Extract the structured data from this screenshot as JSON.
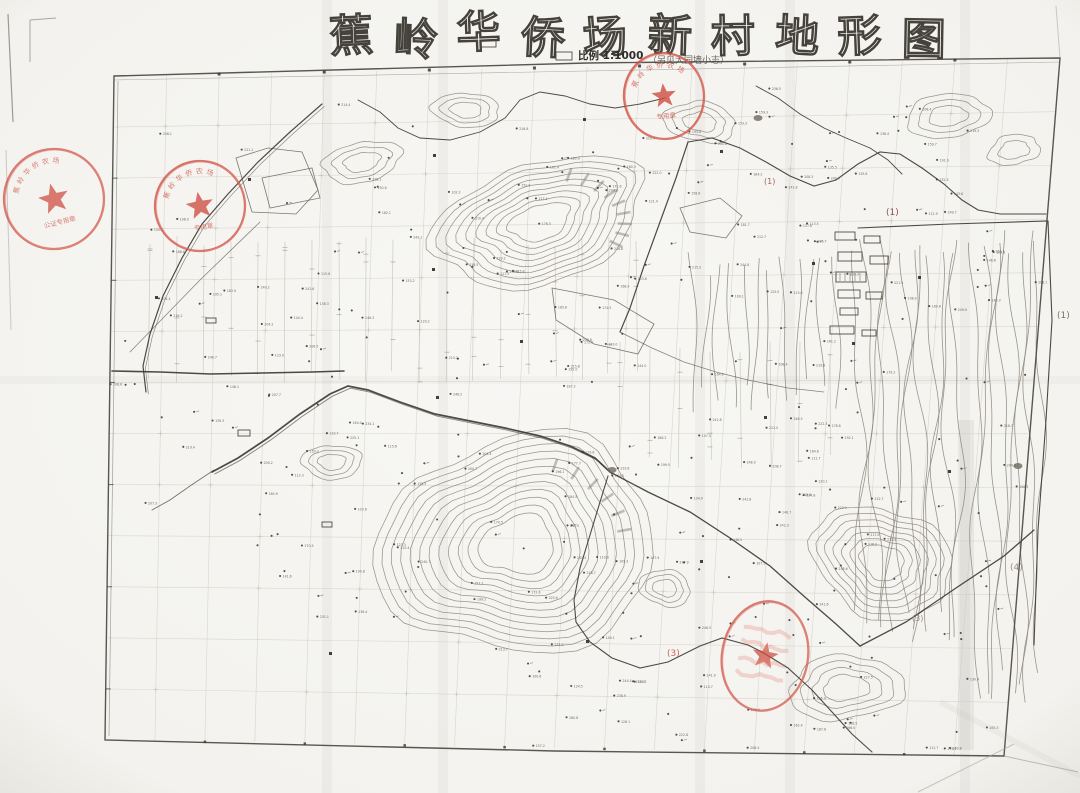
{
  "page": {
    "background": "#f6f5f1",
    "paper_shadow": "#e7e5e0"
  },
  "colors": {
    "ink": "#3e3b35",
    "contour": "#8a857a",
    "contour_dark": "#6e695f",
    "pencil": "#cfccc3",
    "stamp_red": "#cd4a3d",
    "stamp_red_light": "#e2786c",
    "paper": "#f8f7f4"
  },
  "title": {
    "text": "蕉岭华侨场新村地形图",
    "chars": [
      "蕉",
      "岭",
      "华",
      "侨",
      "场",
      "新",
      "村",
      "地",
      "形",
      "图"
    ],
    "x_start": 330,
    "spacing": 63.5,
    "font_size": 44
  },
  "scale": {
    "label": "比例 1:1000",
    "note": "（另见大园墙小志）"
  },
  "stamps": [
    {
      "name": "seal-top-center",
      "cx": 664,
      "cy": 96,
      "rx": 40,
      "ry": 43,
      "rot": -6,
      "ring_text": "蕉岭华侨农场",
      "bottom_text": "专用章",
      "style": "circle",
      "opacity": 0.88
    },
    {
      "name": "seal-left-edge",
      "cx": 54,
      "cy": 199,
      "rx": 50,
      "ry": 50,
      "rot": -14,
      "ring_text": "蕉岭华侨农场",
      "bottom_text": "公证专用章",
      "style": "circle",
      "opacity": 0.8
    },
    {
      "name": "seal-upper-left",
      "cx": 200,
      "cy": 206,
      "rx": 45,
      "ry": 45,
      "rot": -10,
      "ring_text": "蕉岭华侨农场",
      "bottom_text": "专用章",
      "style": "circle",
      "opacity": 0.85
    },
    {
      "name": "seal-bottom",
      "cx": 765,
      "cy": 656,
      "rx": 43,
      "ry": 55,
      "rot": 10,
      "ring_text": "",
      "bottom_text": "",
      "style": "scribble",
      "opacity": 0.8
    }
  ],
  "annotations": [
    {
      "text": "(1)",
      "x": 886,
      "y": 215,
      "color": "#7c453e",
      "size": 9
    },
    {
      "text": "(1)",
      "x": 1057,
      "y": 318,
      "color": "#6b675f",
      "size": 9
    },
    {
      "text": "(1)",
      "x": 764,
      "y": 184,
      "color": "#95544b",
      "size": 8
    },
    {
      "text": "(4)",
      "x": 1010,
      "y": 570,
      "color": "#8b867d",
      "size": 9
    },
    {
      "text": "(3)",
      "x": 667,
      "y": 656,
      "color": "#c4574a",
      "size": 9
    },
    {
      "text": "(3)",
      "x": 912,
      "y": 621,
      "color": "#8b867d",
      "size": 8
    }
  ],
  "map": {
    "border": {
      "corners": [
        [
          114,
          76
        ],
        [
          1060,
          58
        ],
        [
          1004,
          756
        ],
        [
          105,
          740
        ]
      ],
      "grid_cols": 18,
      "grid_rows": 13
    },
    "hills": [
      {
        "cx": 540,
        "cy": 222,
        "rx": 108,
        "ry": 60,
        "rings": 9,
        "rot": -18,
        "seed": 11,
        "hatch": 9
      },
      {
        "cx": 362,
        "cy": 162,
        "rx": 40,
        "ry": 20,
        "rings": 3,
        "rot": -12,
        "seed": 21,
        "hatch": 0
      },
      {
        "cx": 466,
        "cy": 110,
        "rx": 34,
        "ry": 17,
        "rings": 3,
        "rot": 4,
        "seed": 31,
        "hatch": 0
      },
      {
        "cx": 700,
        "cy": 122,
        "rx": 36,
        "ry": 20,
        "rings": 3,
        "rot": 8,
        "seed": 41,
        "hatch": 0
      },
      {
        "cx": 948,
        "cy": 116,
        "rx": 42,
        "ry": 22,
        "rings": 3,
        "rot": -6,
        "seed": 51,
        "hatch": 0
      },
      {
        "cx": 332,
        "cy": 462,
        "rx": 30,
        "ry": 17,
        "rings": 3,
        "rot": 0,
        "seed": 61,
        "hatch": 0
      },
      {
        "cx": 518,
        "cy": 545,
        "rx": 140,
        "ry": 108,
        "rings": 12,
        "rot": -8,
        "seed": 71,
        "hatch": 6
      },
      {
        "cx": 665,
        "cy": 588,
        "rx": 26,
        "ry": 18,
        "rings": 3,
        "rot": 12,
        "seed": 81,
        "hatch": 0
      },
      {
        "cx": 882,
        "cy": 562,
        "rx": 72,
        "ry": 54,
        "rings": 7,
        "rot": 22,
        "seed": 91,
        "hatch": 0
      },
      {
        "cx": 846,
        "cy": 688,
        "rx": 58,
        "ry": 32,
        "rings": 4,
        "rot": -4,
        "seed": 101,
        "hatch": 0
      },
      {
        "cx": 1014,
        "cy": 150,
        "rx": 26,
        "ry": 15,
        "rings": 2,
        "rot": -10,
        "seed": 111,
        "hatch": 0
      }
    ],
    "slopes": [
      {
        "x": 858,
        "y0": 234,
        "y1": 646,
        "n": 12,
        "dx": 9,
        "amp": 6,
        "seed": 5
      },
      {
        "x": 976,
        "y0": 230,
        "y1": 706,
        "n": 8,
        "dx": 9,
        "amp": 5,
        "seed": 6
      },
      {
        "x": 692,
        "y0": 252,
        "y1": 418,
        "n": 12,
        "dx": 13,
        "amp": 4,
        "seed": 7
      }
    ],
    "lines": [
      {
        "pts": [
          [
            212,
            472
          ],
          [
            238,
            458
          ],
          [
            268,
            438
          ],
          [
            300,
            414
          ],
          [
            330,
            394
          ],
          [
            348,
            386
          ],
          [
            368,
            390
          ],
          [
            400,
            402
          ],
          [
            435,
            414
          ],
          [
            470,
            421
          ],
          [
            505,
            428
          ],
          [
            540,
            436
          ],
          [
            570,
            446
          ],
          [
            595,
            458
          ],
          [
            610,
            472
          ]
        ],
        "w": 1.7,
        "double": true
      },
      {
        "pts": [
          [
            610,
            472
          ],
          [
            648,
            492
          ],
          [
            690,
            512
          ],
          [
            730,
            538
          ],
          [
            770,
            566
          ],
          [
            806,
            598
          ],
          [
            836,
            624
          ],
          [
            860,
            646
          ]
        ],
        "w": 1.3
      },
      {
        "pts": [
          [
            860,
            646
          ],
          [
            906,
            622
          ],
          [
            956,
            588
          ],
          [
            1004,
            556
          ],
          [
            1034,
            530
          ]
        ],
        "w": 1.3
      },
      {
        "pts": [
          [
            608,
            476
          ],
          [
            600,
            502
          ],
          [
            590,
            535
          ],
          [
            580,
            568
          ],
          [
            574,
            600
          ],
          [
            576,
            622
          ],
          [
            590,
            642
          ],
          [
            612,
            658
          ],
          [
            640,
            668
          ],
          [
            668,
            662
          ],
          [
            700,
            646
          ],
          [
            722,
            638
          ],
          [
            748,
            645
          ],
          [
            762,
            652
          ]
        ],
        "w": 1.1
      },
      {
        "pts": [
          [
            762,
            652
          ],
          [
            788,
            668
          ],
          [
            812,
            690
          ],
          [
            832,
            712
          ],
          [
            852,
            734
          ],
          [
            872,
            752
          ]
        ],
        "w": 1.1
      },
      {
        "pts": [
          [
            688,
            142
          ],
          [
            676,
            178
          ],
          [
            660,
            222
          ],
          [
            644,
            266
          ],
          [
            630,
            308
          ],
          [
            620,
            332
          ]
        ],
        "w": 1.2
      },
      {
        "pts": [
          [
            688,
            142
          ],
          [
            712,
            138
          ],
          [
            740,
            148
          ],
          [
            766,
            162
          ],
          [
            790,
            176
          ],
          [
            814,
            186
          ],
          [
            836,
            180
          ],
          [
            858,
            164
          ],
          [
            880,
            152
          ],
          [
            900,
            154
          ],
          [
            922,
            168
          ],
          [
            944,
            184
          ],
          [
            962,
            200
          ],
          [
            978,
            210
          ],
          [
            1000,
            214
          ],
          [
            1024,
            214
          ],
          [
            1046,
            214
          ]
        ],
        "w": 1.1
      },
      {
        "pts": [
          [
            322,
            104
          ],
          [
            290,
            132
          ],
          [
            258,
            162
          ],
          [
            228,
            194
          ],
          [
            202,
            224
          ],
          [
            182,
            258
          ],
          [
            163,
            296
          ],
          [
            150,
            334
          ],
          [
            143,
            366
          ],
          [
            146,
            392
          ]
        ],
        "w": 1.2,
        "double": true
      },
      {
        "pts": [
          [
            112,
            371
          ],
          [
            160,
            372
          ],
          [
            210,
            374
          ],
          [
            262,
            373
          ],
          [
            312,
            372
          ],
          [
            344,
            371
          ]
        ],
        "w": 1.6
      },
      {
        "pts": [
          [
            358,
            100
          ],
          [
            380,
            112
          ],
          [
            398,
            128
          ],
          [
            420,
            138
          ],
          [
            450,
            140
          ],
          [
            480,
            132
          ],
          [
            505,
            118
          ],
          [
            520,
            100
          ],
          [
            540,
            92
          ],
          [
            565,
            96
          ],
          [
            590,
            104
          ],
          [
            615,
            108
          ],
          [
            640,
            104
          ],
          [
            665,
            98
          ]
        ],
        "w": 0.9
      },
      {
        "pts": [
          [
            756,
            86
          ],
          [
            778,
            98
          ],
          [
            800,
            114
          ],
          [
            824,
            128
          ],
          [
            846,
            138
          ],
          [
            870,
            148
          ],
          [
            888,
            160
          ],
          [
            902,
            174
          ]
        ],
        "w": 0.9
      },
      {
        "pts": [
          [
            858,
            228
          ],
          [
            950,
            224
          ],
          [
            1048,
            221
          ],
          [
            1052,
            320
          ],
          [
            1046,
            420
          ],
          [
            1038,
            530
          ],
          [
            1034,
            645
          ]
        ],
        "w": 1.1
      },
      {
        "pts": [
          [
            130,
            352
          ],
          [
            200,
            280
          ],
          [
            260,
            222
          ]
        ],
        "w": 0.8,
        "op": 0.6
      },
      {
        "pts": [
          [
            620,
            332
          ],
          [
            652,
            348
          ],
          [
            684,
            362
          ],
          [
            716,
            372
          ],
          [
            748,
            380
          ],
          [
            788,
            388
          ],
          [
            824,
            392
          ]
        ],
        "w": 0.8,
        "op": 0.6
      },
      {
        "pts": [
          [
            214,
            470
          ],
          [
            190,
            486
          ],
          [
            170,
            500
          ],
          [
            152,
            510
          ]
        ],
        "w": 0.9,
        "op": 0.7
      }
    ],
    "polygons": [
      [
        [
          236,
          158
        ],
        [
          268,
          148
        ],
        [
          302,
          152
        ],
        [
          318,
          190
        ],
        [
          296,
          214
        ],
        [
          252,
          212
        ]
      ],
      [
        [
          552,
          288
        ],
        [
          614,
          300
        ],
        [
          654,
          324
        ],
        [
          638,
          354
        ],
        [
          594,
          344
        ],
        [
          556,
          320
        ]
      ],
      [
        [
          262,
          178
        ],
        [
          312,
          168
        ],
        [
          320,
          198
        ],
        [
          270,
          208
        ]
      ],
      [
        [
          680,
          208
        ],
        [
          720,
          198
        ],
        [
          742,
          216
        ],
        [
          726,
          238
        ],
        [
          690,
          232
        ]
      ]
    ],
    "buildings": [
      {
        "x": 835,
        "y": 232,
        "w": 20,
        "h": 8
      },
      {
        "x": 864,
        "y": 236,
        "w": 16,
        "h": 7
      },
      {
        "x": 838,
        "y": 252,
        "w": 24,
        "h": 9
      },
      {
        "x": 870,
        "y": 256,
        "w": 18,
        "h": 8
      },
      {
        "x": 836,
        "y": 272,
        "w": 30,
        "h": 10,
        "hatch": true
      },
      {
        "x": 838,
        "y": 290,
        "w": 22,
        "h": 8
      },
      {
        "x": 866,
        "y": 292,
        "w": 16,
        "h": 7
      },
      {
        "x": 840,
        "y": 308,
        "w": 18,
        "h": 7
      },
      {
        "x": 830,
        "y": 326,
        "w": 24,
        "h": 8
      },
      {
        "x": 862,
        "y": 330,
        "w": 14,
        "h": 6
      },
      {
        "x": 478,
        "y": 38,
        "w": 18,
        "h": 9
      },
      {
        "x": 556,
        "y": 52,
        "w": 16,
        "h": 8
      },
      {
        "x": 206,
        "y": 318,
        "w": 10,
        "h": 5
      },
      {
        "x": 238,
        "y": 430,
        "w": 12,
        "h": 6
      },
      {
        "x": 322,
        "y": 522,
        "w": 10,
        "h": 5
      }
    ],
    "solid_marks": [
      [
        155,
        296
      ],
      [
        248,
        178
      ],
      [
        433,
        154
      ],
      [
        583,
        118
      ],
      [
        720,
        150
      ],
      [
        812,
        262
      ],
      [
        852,
        342
      ],
      [
        918,
        276
      ],
      [
        700,
        560
      ],
      [
        520,
        340
      ],
      [
        586,
        640
      ],
      [
        432,
        268
      ],
      [
        764,
        416
      ],
      [
        948,
        470
      ],
      [
        436,
        396
      ],
      [
        329,
        652
      ]
    ],
    "water_marks": [
      [
        612,
        470
      ],
      [
        1018,
        466
      ],
      [
        758,
        118
      ]
    ],
    "field_bands": [
      {
        "x0": 150,
        "x1": 640,
        "y0": 236,
        "y1": 384,
        "step": 27
      },
      {
        "x0": 620,
        "x1": 850,
        "y0": 340,
        "y1": 468,
        "step": 30
      }
    ],
    "spot_elevations": {
      "count": 380,
      "seed": 7,
      "style": "dot-with-tiny-number"
    },
    "creases": {
      "vertical_x": [
        327,
        443,
        700,
        790,
        965
      ],
      "horizontal_y": [
        380
      ]
    }
  }
}
